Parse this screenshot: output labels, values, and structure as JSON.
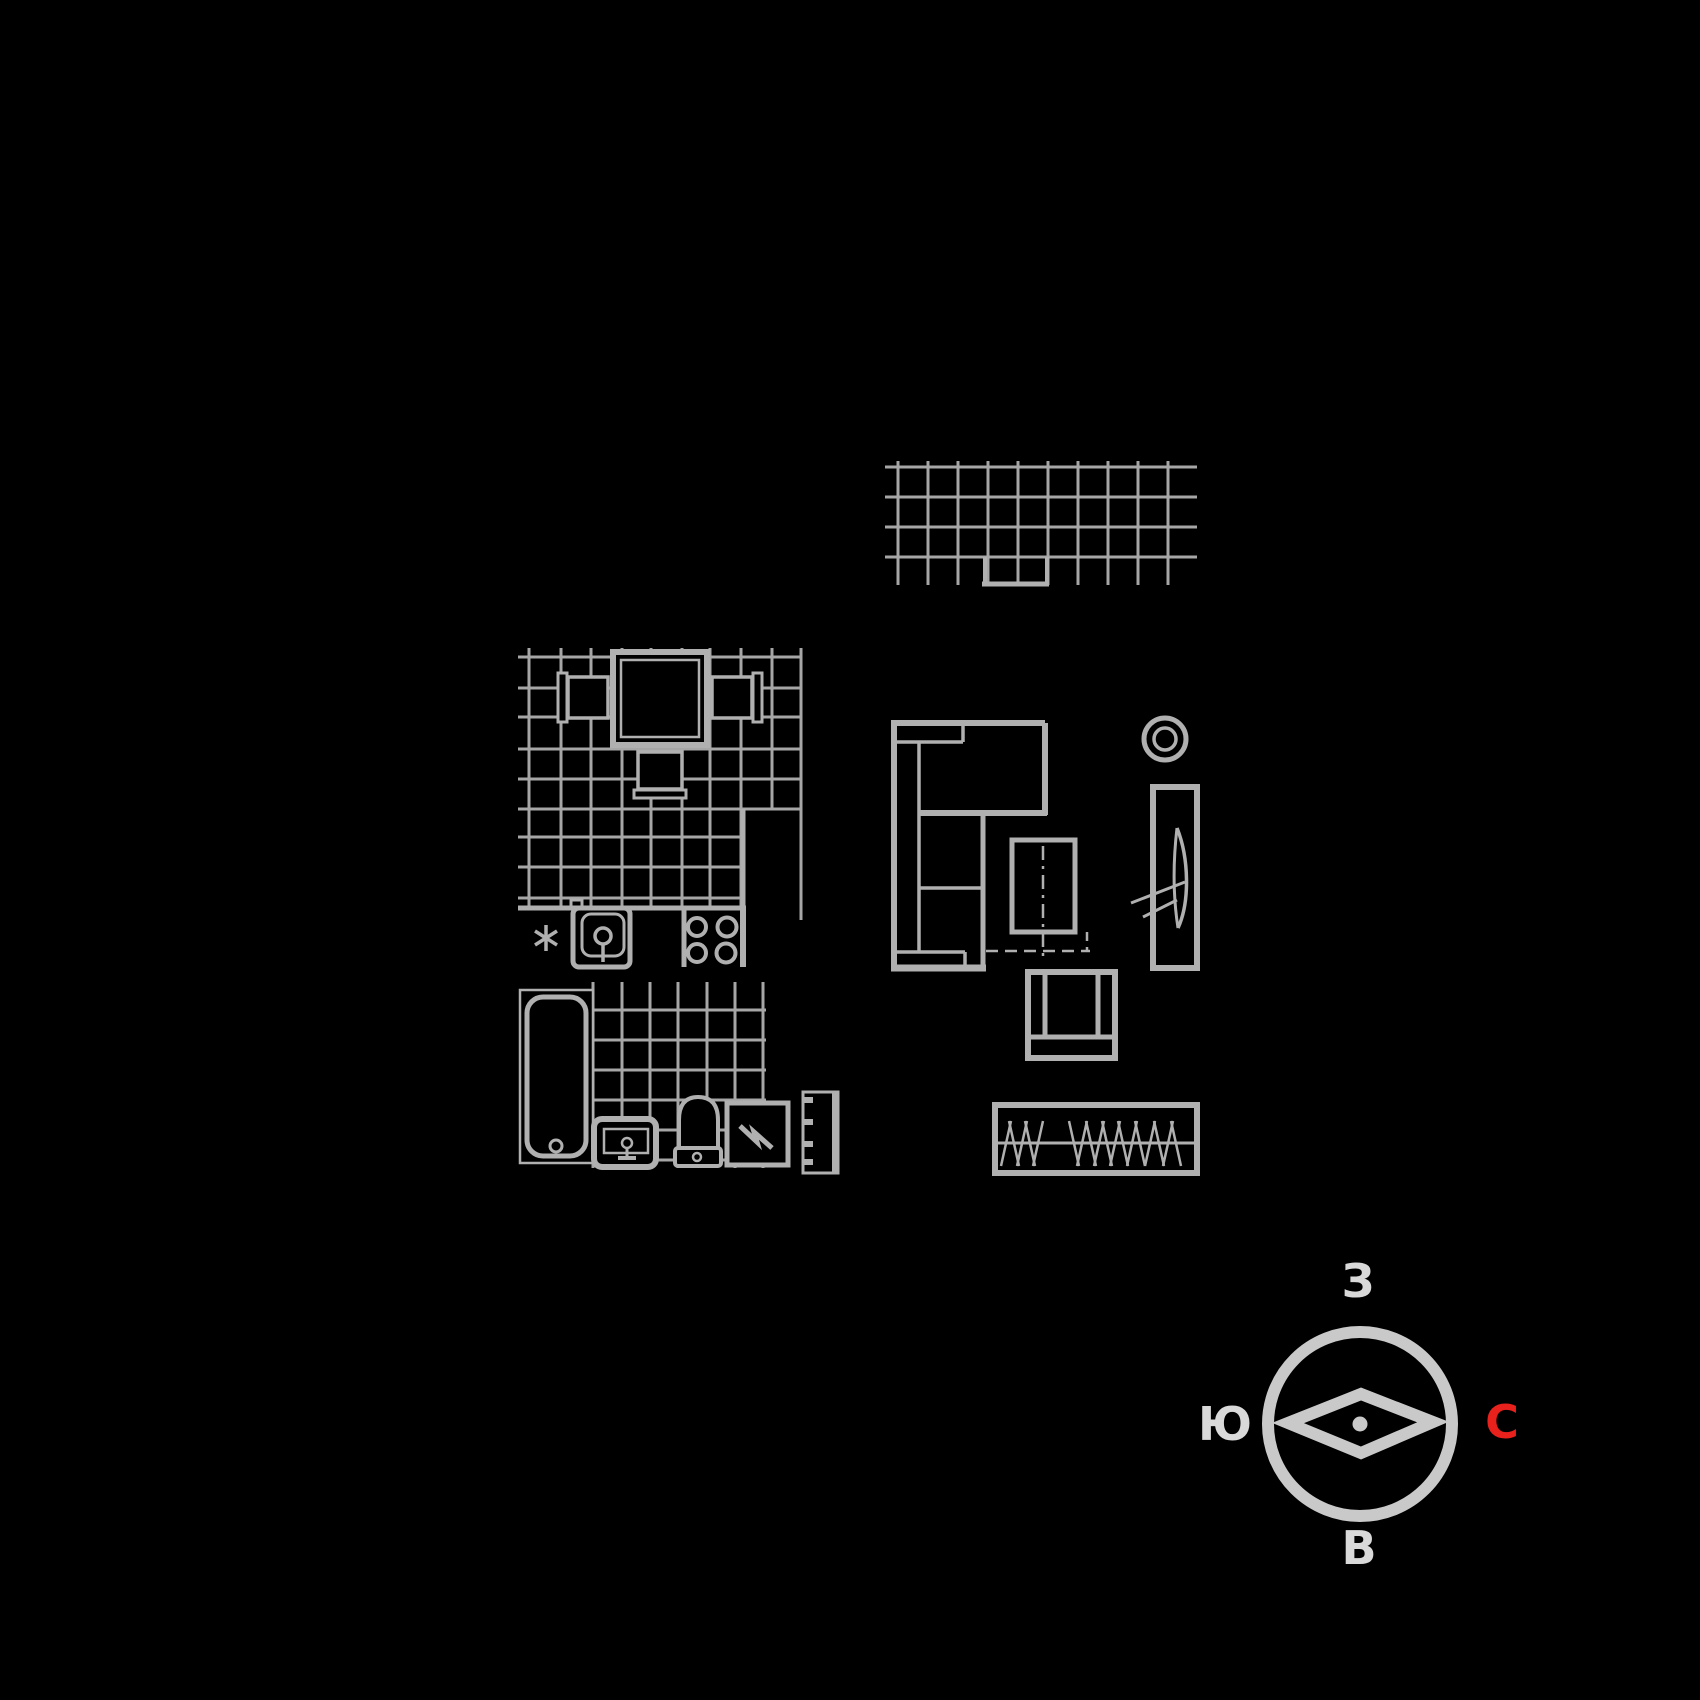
{
  "palette": {
    "background": "#000000",
    "grid_line": "#a6a6a6",
    "object_line": "#b0b0b0",
    "compass_ring": "#c9c9c9",
    "compass_label": "#d9d9d9",
    "compass_north": "#e8211d"
  },
  "compass": {
    "top_label": "З",
    "left_label": "Ю",
    "right_label": "С",
    "bottom_label": "В"
  }
}
